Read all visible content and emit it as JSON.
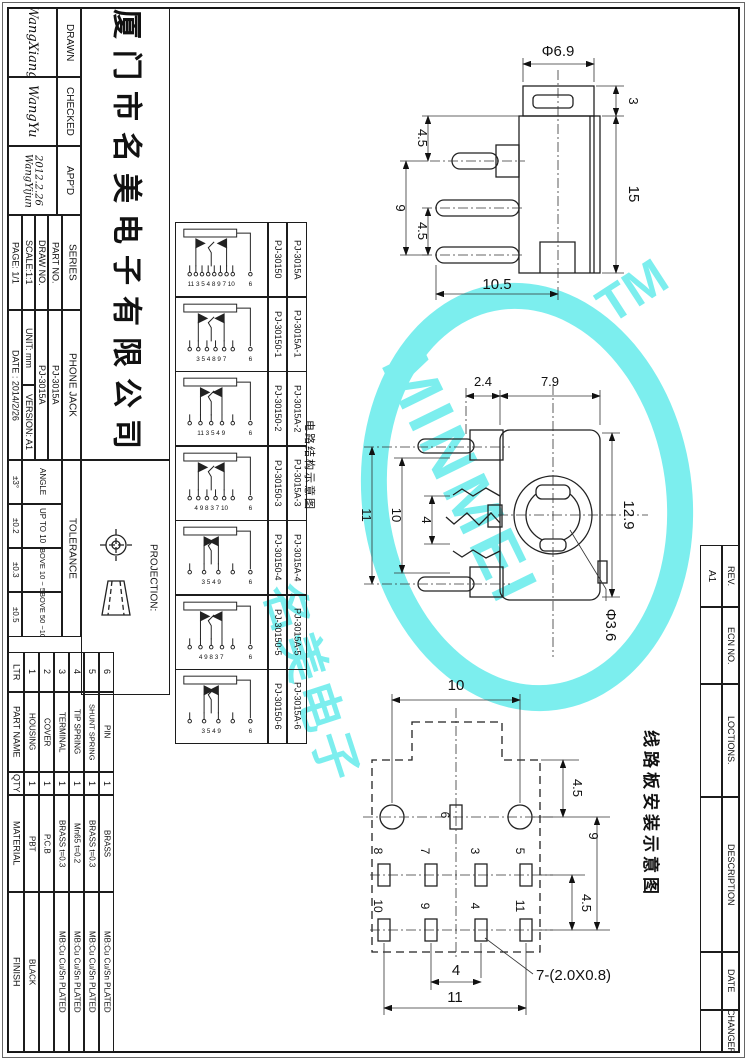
{
  "sheet": {
    "company": "厦门市名美电子有限公司",
    "signatures": {
      "drawn_label": "DRAWN",
      "drawn": "WangXiang",
      "checked_label": "CHECKED",
      "checked": "WangYu",
      "appd_label": "APP'D",
      "appd": "WangYijun",
      "appd_date": "2012.2.26"
    },
    "fields": {
      "series_label": "SERIES",
      "series": "PHONE JACK",
      "part_no_label": "PART NO.",
      "part_no": "PJ-3015A",
      "draw_no_label": "DRAW NO.",
      "draw_no": "PJ-3015A",
      "scale": "SCALE:1:1",
      "unit": "UNIT: mm",
      "version": "VERSION: A1",
      "page": "PAGE: 1/1",
      "date": "DATE : 2014/2/26"
    },
    "tolerance": {
      "label": "TOLERANCE",
      "rows": [
        {
          "range": "ANGLE",
          "value": "±3°"
        },
        {
          "range": "UP TO 10",
          "value": "±0.2"
        },
        {
          "range": "ABOVE 10 ~ 50",
          "value": "±0.3"
        },
        {
          "range": "ABOVE 50 ~100",
          "value": "±0.5"
        }
      ]
    },
    "projection_label": "PROJECTION:"
  },
  "variants": {
    "caption": "电路结构示意图",
    "rows": [
      {
        "drawing_no": "PJ-30150",
        "part_no": "PJ-3015A",
        "pins": "11 3 5 4 8 9 7 10",
        "sleeve": "6"
      },
      {
        "drawing_no": "PJ-30150-1",
        "part_no": "PJ-3015A-1",
        "pins": "3 5 4 8 9 7",
        "sleeve": "6"
      },
      {
        "drawing_no": "PJ-30150-2",
        "part_no": "PJ-3015A-2",
        "pins": "11 3 5 4 9",
        "sleeve": "6"
      },
      {
        "drawing_no": "PJ-30150-3",
        "part_no": "PJ-3015A-3",
        "pins": "4 9 8 3 7 10",
        "sleeve": "6"
      },
      {
        "drawing_no": "PJ-30150-4",
        "part_no": "PJ-3015A-4",
        "pins": "3 5 4 9",
        "sleeve": "6"
      },
      {
        "drawing_no": "PJ-30150-5",
        "part_no": "PJ-3015A-5",
        "pins": "4 9 8 3 7",
        "sleeve": "6"
      },
      {
        "drawing_no": "PJ-30150-6",
        "part_no": "PJ-3015A-6",
        "pins": "3 5 4 9",
        "sleeve": "6"
      }
    ]
  },
  "parts": {
    "headers": {
      "ltr": "LTR",
      "part_name": "PART NAME",
      "qty": "QTY",
      "material": "MATERIAL",
      "finish": "FINISH"
    },
    "rows": [
      {
        "ltr": "1",
        "part_name": "HOUSING",
        "qty": "1",
        "material": "PBT",
        "finish": "BLACK"
      },
      {
        "ltr": "2",
        "part_name": "COVER",
        "qty": "1",
        "material": "P.C.B",
        "finish": ""
      },
      {
        "ltr": "3",
        "part_name": "TERMINAL",
        "qty": "1",
        "material": "BRASS t=0.3",
        "finish": "MB:Cu  Cu/Sn  PLATED"
      },
      {
        "ltr": "4",
        "part_name": "TIP SPRING",
        "qty": "1",
        "material": "Mn65 t=0.2",
        "finish": "MB:Cu  Cu/Sn  PLATED"
      },
      {
        "ltr": "5",
        "part_name": "SHUNT SPRING",
        "qty": "1",
        "material": "BRASS t=0.3",
        "finish": "MB:Cu  Cu/Sn  PLATED"
      },
      {
        "ltr": "6",
        "part_name": "PIN",
        "qty": "1",
        "material": "BRASS",
        "finish": "MB:Cu  Cu/Sn  PLATED"
      }
    ]
  },
  "revision": {
    "rows": [
      {
        "label": "REV.",
        "value": "A1"
      },
      {
        "label": "ECN NO.",
        "value": ""
      },
      {
        "label": "LOCTIONS.",
        "value": ""
      },
      {
        "label": "DESCRIPTION",
        "value": ""
      },
      {
        "label": "DATE",
        "value": ""
      },
      {
        "label": "CHANGER",
        "value": ""
      }
    ]
  },
  "views": {
    "side": {
      "dia": "Φ6.9",
      "cap_h": "3",
      "body_h": "15",
      "p1": "4.5",
      "p2": "9",
      "p3": "4.5",
      "depth": "10.5"
    },
    "front": {
      "d1": "2.4",
      "d2": "7.9",
      "left1": "11",
      "left2": "10",
      "left3": "4",
      "right": "12.9",
      "hole": "Φ3.6"
    },
    "pcb": {
      "caption": "线路板安装示意图",
      "top": "10",
      "r1": "4.5",
      "r2": "9",
      "r3": "4.5",
      "b1": "4",
      "b2": "11",
      "note": "7-(2.0X0.8)",
      "pads": {
        "p6": "6",
        "p8": "8",
        "p7": "7",
        "p3": "3",
        "p5": "5",
        "p10": "10",
        "p9": "9",
        "p4": "4",
        "p11": "11"
      }
    }
  },
  "watermark": {
    "tm": "TM",
    "brand": "MINMEI",
    "cn": "名美电子",
    "color": "#7ceeee"
  }
}
